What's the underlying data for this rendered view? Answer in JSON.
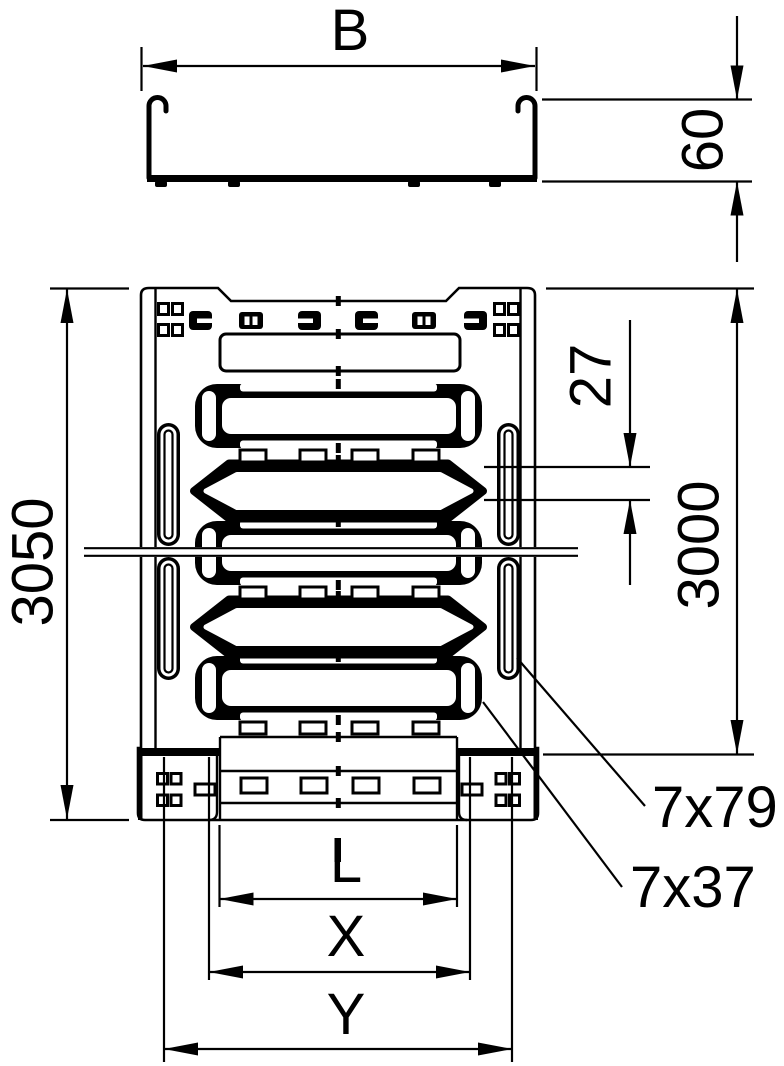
{
  "cross_section": {
    "width_label": "B",
    "height_label": "60"
  },
  "plan": {
    "overall_length_label": "3050",
    "pitch_label": "27",
    "length_label": "3000",
    "side_slot_label": "7x79",
    "base_slot_label": "7x37",
    "l_label": "L",
    "x_label": "X",
    "y_label": "Y"
  },
  "colors": {
    "ink": "#000000",
    "paper": "#ffffff"
  }
}
